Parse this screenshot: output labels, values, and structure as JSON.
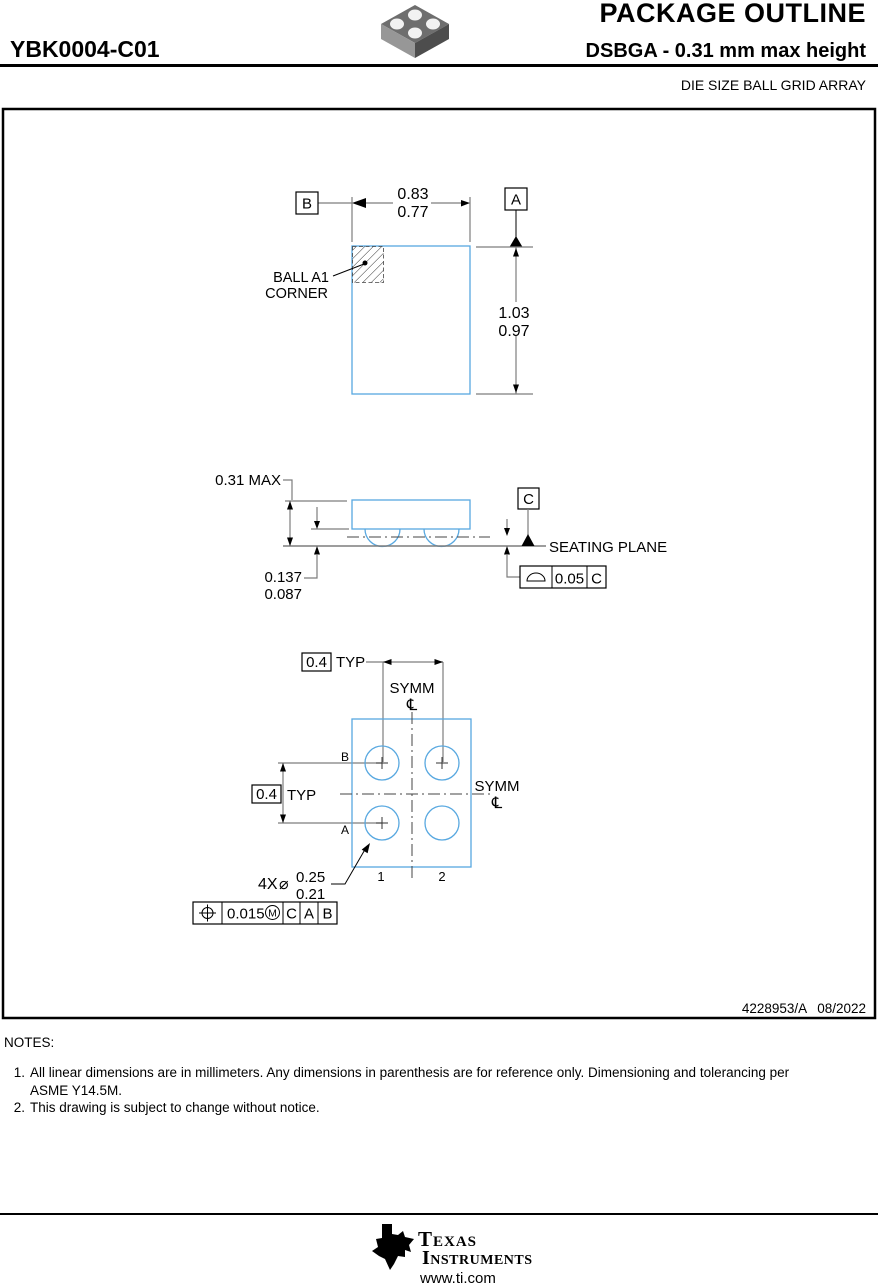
{
  "colors": {
    "package_outline_blue": "#58a8e0",
    "dimension_line_gray": "#7d7d7d",
    "text_black": "#000000"
  },
  "header": {
    "title": "PACKAGE OUTLINE",
    "part_number": "YBK0004-C01",
    "subtitle": "DSBGA - 0.31 mm max height",
    "package_family": "DIE SIZE BALL GRID ARRAY"
  },
  "top_view": {
    "width_dim_max": "0.83",
    "width_dim_min": "0.77",
    "height_dim_max": "1.03",
    "height_dim_min": "0.97",
    "datum_b": "B",
    "datum_a": "A",
    "ball_a1_line1": "BALL A1",
    "ball_a1_line2": "CORNER"
  },
  "side_view": {
    "overall_height": "0.31 MAX",
    "standoff_max": "0.137",
    "standoff_min": "0.087",
    "datum_c": "C",
    "seating_plane": "SEATING PLANE",
    "coplanarity_symbol_icon": "half-disc-seating-plane-symbol",
    "coplanarity_value": "0.05",
    "coplanarity_datum": "C"
  },
  "bottom_view": {
    "pitch_value_top": "0.4",
    "pitch_typ_top": "TYP",
    "pitch_value_left": "0.4",
    "pitch_typ_left": "TYP",
    "symm_top": "SYMM",
    "centerline_symbol_top": "℄",
    "symm_right": "SYMM",
    "centerline_symbol_right": "℄",
    "row_label_b": "B",
    "row_label_a": "A",
    "col_label_1": "1",
    "col_label_2": "2",
    "ball_count": "4X",
    "ball_diameter_symbol": "⌀",
    "ball_dia_max": "0.25",
    "ball_dia_min": "0.21",
    "position_symbol_icon": "crosshair-circle-position-symbol",
    "position_tolerance": "0.015",
    "position_modifier": "M",
    "position_datum_1": "C",
    "position_datum_2": "A",
    "position_datum_3": "B"
  },
  "title_block": {
    "doc_number": "4228953/A",
    "revision_date": "08/2022"
  },
  "notes": {
    "heading": "NOTES:",
    "items": [
      {
        "num": "1.",
        "text": "All linear dimensions are in millimeters. Any dimensions in parenthesis are for reference only. Dimensioning and tolerancing per ASME Y14.5M."
      },
      {
        "num": "2.",
        "text": "This drawing is subject to change without notice."
      }
    ]
  },
  "footer": {
    "logo_monogram": "ti",
    "brand_top": "Texas",
    "brand_bottom": "Instruments",
    "url": "www.ti.com"
  }
}
